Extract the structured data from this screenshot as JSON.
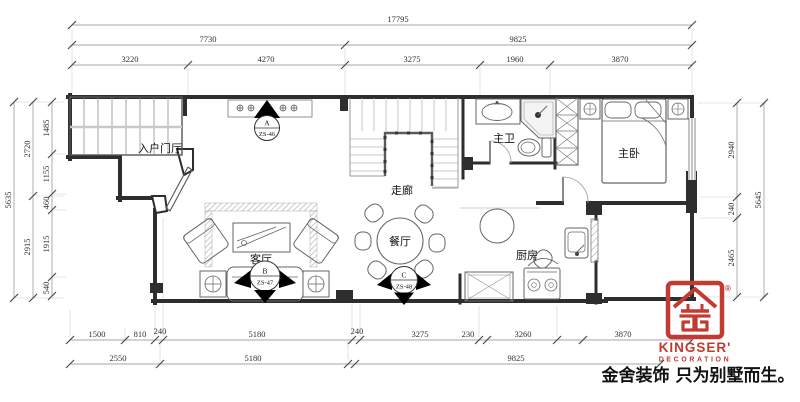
{
  "title": "floor-plan",
  "rooms": {
    "entry": "入户门厅",
    "living": "客厅",
    "corridor": "走廊",
    "dining": "餐厅",
    "master_bath": "主卫",
    "master_bed": "主卧",
    "kitchen": "厨房"
  },
  "markers": [
    {
      "letter": "A",
      "code": "ZS-46"
    },
    {
      "letter": "B",
      "code": "ZS-47"
    },
    {
      "letter": "C",
      "code": "ZS-48"
    }
  ],
  "dims": {
    "top_row1": [
      "17795"
    ],
    "top_row2": [
      "7730",
      "9825"
    ],
    "top_row3": [
      "3220",
      "4270",
      "3275",
      "1960",
      "3870"
    ],
    "bottom_row1": [
      "1500",
      "810",
      "240",
      "5180",
      "240",
      "3275",
      "230",
      "3260",
      "3870"
    ],
    "bottom_row2": [
      "2550",
      "5180",
      "9825"
    ],
    "left_outer": [
      "5635"
    ],
    "left_mid": [
      "2720",
      "2915"
    ],
    "left_inner": [
      "1485",
      "1155",
      "460",
      "1915",
      "540"
    ],
    "right_inner": [
      "2940",
      "240",
      "2465"
    ],
    "right_outer": [
      "5645"
    ]
  },
  "logo": {
    "brand": "KINGSER'",
    "sub": "DECORATION",
    "registered": "®",
    "tagline": "金舍装饰 只为别墅而生。",
    "red": "#c23a30"
  }
}
